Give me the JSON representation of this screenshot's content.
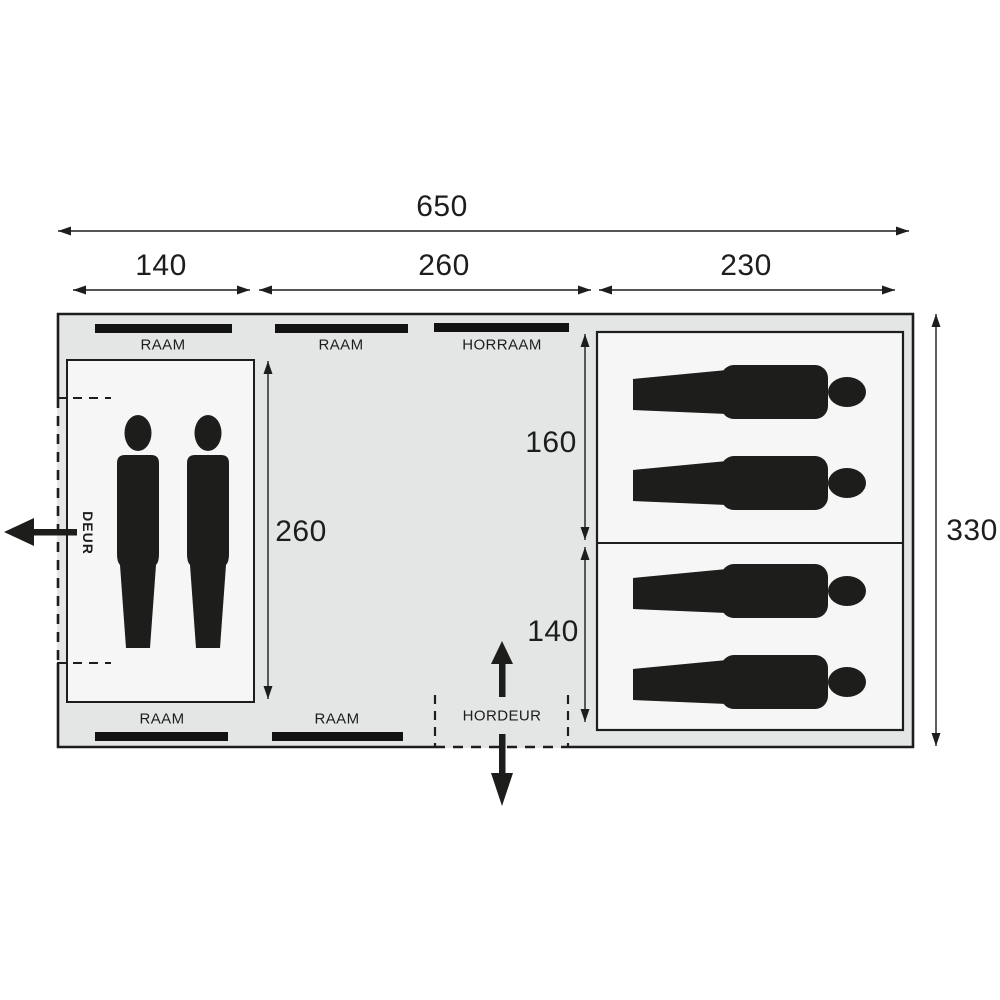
{
  "plan": {
    "title": "tent-floor-plan",
    "dimensions": {
      "total_width": "650",
      "section_left": "140",
      "section_middle": "260",
      "section_right": "230",
      "total_height": "330",
      "living_room_depth": "260",
      "sleeping_cabin_top": "160",
      "sleeping_cabin_bottom": "140"
    },
    "labels": {
      "window_top_left": "RAAM",
      "window_top_middle": "RAAM",
      "mesh_window": "HORRAAM",
      "window_bottom_left": "RAAM",
      "window_bottom_middle": "RAAM",
      "mesh_door": "HORDEUR",
      "door": "DEUR"
    },
    "icons": {
      "standing_person": "standing-person-icon",
      "sleeping_person": "sleeping-person-icon",
      "standing_person_count": 2,
      "sleeping_person_count": 4
    },
    "colors": {
      "tent_fill": "#e3e6e4",
      "room_fill": "#f5f6f5",
      "line": "#1d1d1b",
      "window_bar": "#121212"
    }
  }
}
